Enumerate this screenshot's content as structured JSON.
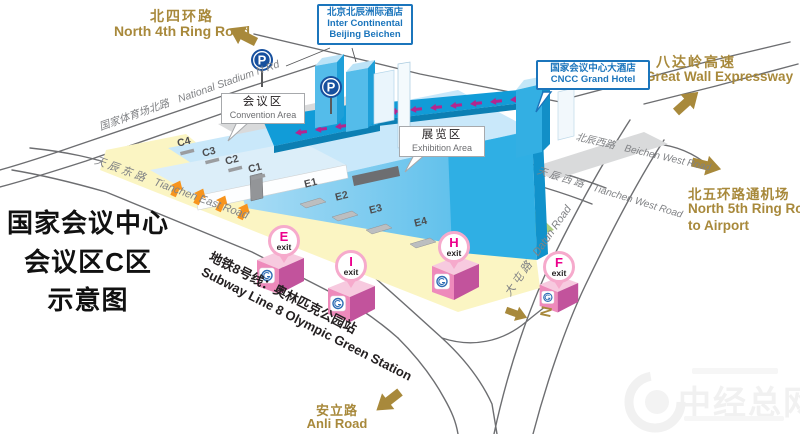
{
  "title": {
    "lines": [
      "国家会议中心",
      "会议区C区",
      "示意图"
    ]
  },
  "destinations": {
    "north_4th_ring": {
      "cn": "北四环路",
      "en": "North 4th Ring Road"
    },
    "great_wall_expressway": {
      "cn": "八达岭高速",
      "en": "Great Wall Expressway"
    },
    "north_5th_ring": {
      "cn": "北五环路通机场",
      "en1": "North 5th Ring Road",
      "en2": "to Airport"
    },
    "anli_road": {
      "cn": "安立路",
      "en": "Anli Road"
    }
  },
  "roads": {
    "national_stadium_n": {
      "cn": "国家体育场北路",
      "en": "National Stadium N Rd"
    },
    "tianchen_east": {
      "cn": "天 辰 东 路",
      "en": "Tianchen East Road"
    },
    "beichen_west": {
      "cn": "北辰西路",
      "en": "Beichen West Road"
    },
    "tianchen_west": {
      "cn": "天 辰 西 路",
      "en": "Tianchen West Road"
    },
    "datun": {
      "cn": "大 屯 路",
      "en": "Datun Road"
    }
  },
  "hotels": {
    "intercontinental": {
      "cn": "北京北辰洲际酒店",
      "en1": "Inter Continental",
      "en2": "Beijing Beichen"
    },
    "cncc_grand": {
      "cn": "国家会议中心大酒店",
      "en": "CNCC Grand Hotel"
    }
  },
  "areas": {
    "convention": {
      "cn": "会议区",
      "en": "Convention Area"
    },
    "exhibition": {
      "cn": "展览区",
      "en": "Exhibition Area"
    }
  },
  "gates": {
    "c": [
      "C4",
      "C3",
      "C2",
      "C1"
    ],
    "e": [
      "E1",
      "E2",
      "E3",
      "E4"
    ]
  },
  "subway": {
    "line_cn": "地铁8号线：奥林匹克公园站",
    "line_en": "Subway Line 8  Olympic Green Station",
    "exit_label": "exit",
    "exits": [
      "E",
      "I",
      "H",
      "F"
    ]
  },
  "parking_label": "P",
  "compass_label": "N",
  "watermark": "中经总网",
  "colors": {
    "gold": "#A8893B",
    "hotel_blue": "#1B75BC",
    "exit_magenta": "#EC008C",
    "building_cyan": "#2FAFE4",
    "walkway_blue": "#119CD8",
    "parking_navy": "#17509E",
    "gate_arrow_orange": "#F7941D"
  }
}
